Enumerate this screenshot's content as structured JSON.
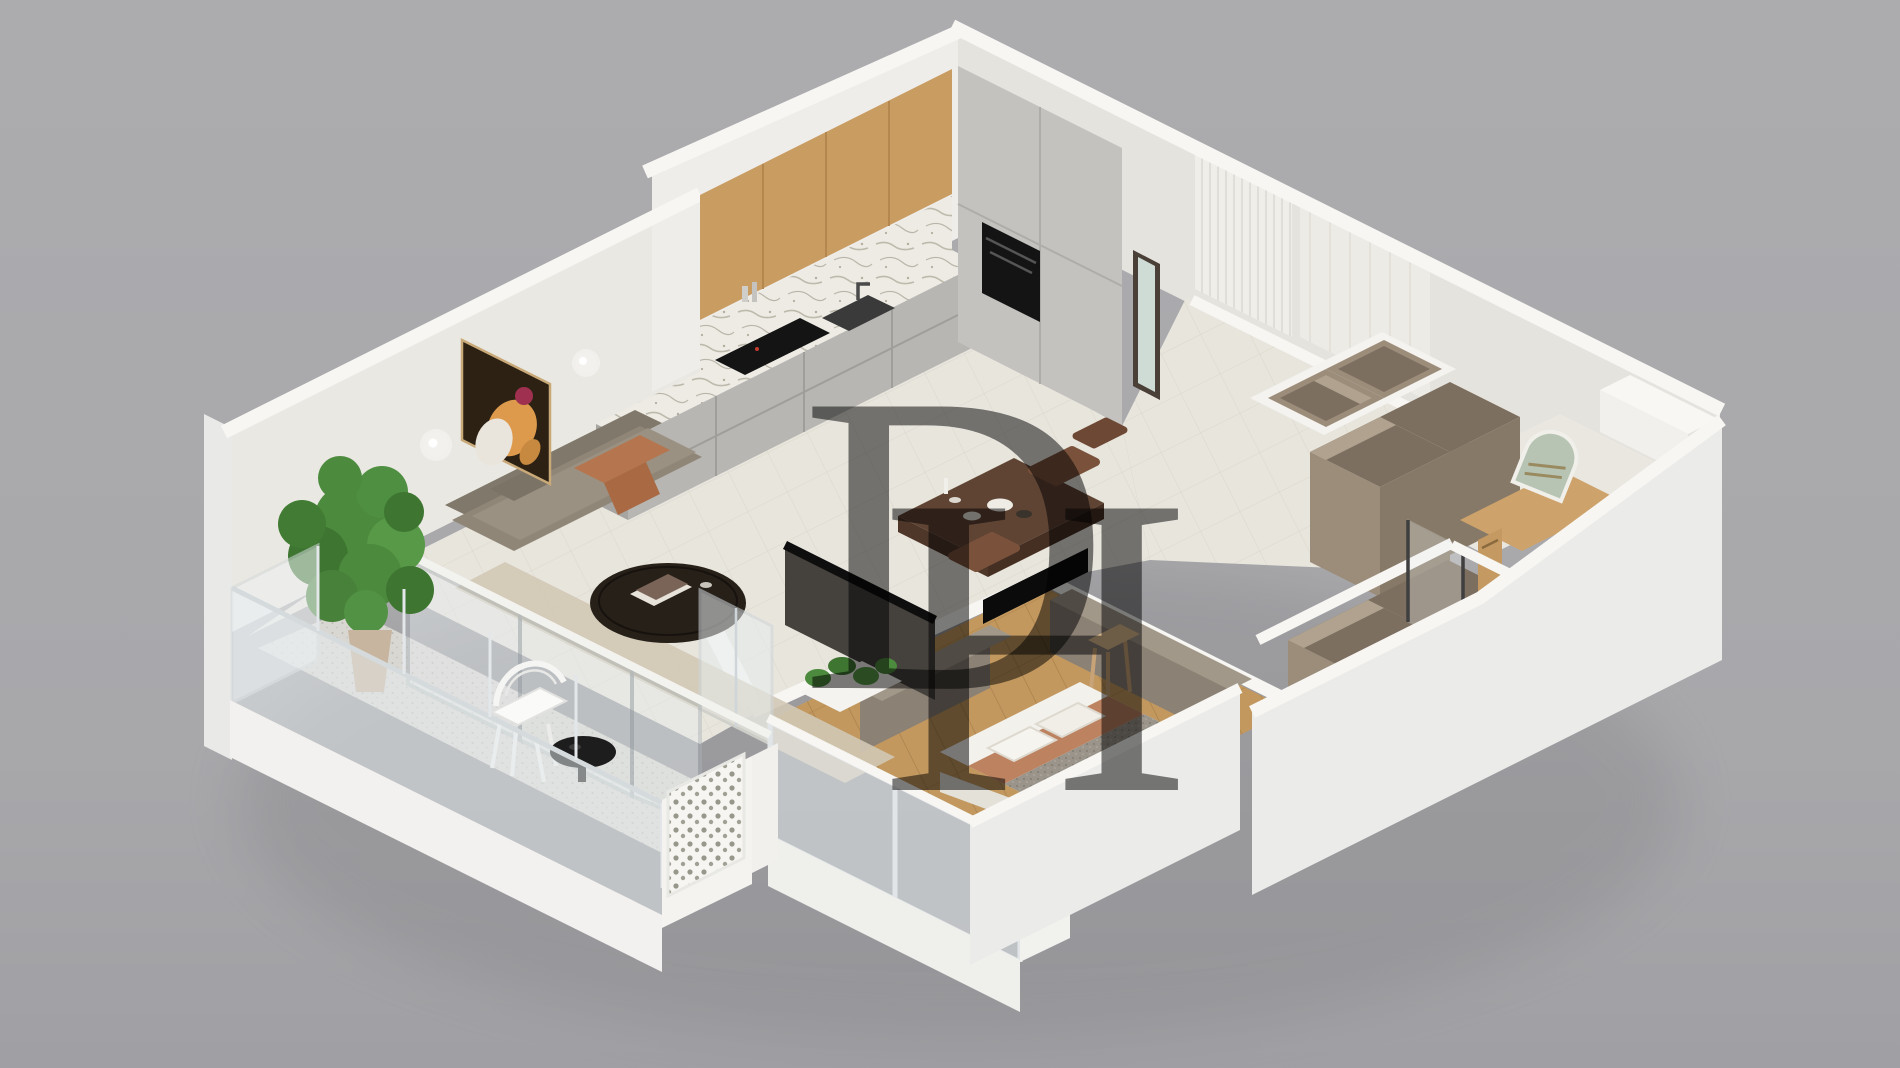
{
  "scene": {
    "description": "3D isometric cutaway render of a one-bedroom apartment floor plan on a neutral gray background",
    "view": "isometric dollhouse cutaway",
    "background": "#a9a9ac"
  },
  "watermark": {
    "d": "D",
    "h": "H",
    "color": "#f6f6f4",
    "opacity": 0.5
  },
  "palette": {
    "bg": "#a9a9ac",
    "bgBottom": "#a0a0a4",
    "shadow": "#6f6f73",
    "wallCap": "#fafaf8",
    "wallFaceSE": "#eae8e2",
    "wallFaceKitchen": "#eeede9",
    "wallFaceSW": "#e5e3dd",
    "wallOuter": "#e9e9e7",
    "wallOuterBig": "#ebebe9",
    "floorTile": "#e8e5dd",
    "tileLine": "#d7d3c7",
    "floorWood": "#c2985f",
    "woodLine": "#a07b45",
    "bathWood": "#cda26b",
    "balconyFloor": "#d9d7d2",
    "glass": "#e7edef",
    "glassFrame": "#aeb7bc",
    "marble": "#edebe3",
    "marbleVein": "#b2ad9f",
    "counterFace": "#b7b6b2",
    "counterEnd": "#a6a5a1",
    "cabinetTall": "#c3c2be",
    "woodCabinet": "#c99c62",
    "appliance": "#141414",
    "mirrorFrame": "#4a4038",
    "mirrorGlass": "#cfdcd6",
    "ribPanel": "#efeee9",
    "sofa": "#8f8678",
    "sofaBack": "#80786a",
    "sofaSeat": "#9a9183",
    "terracotta": "#b5754e",
    "rug": "#d2c8b5",
    "tableBlack": "#262019",
    "walnut": "#5f4434",
    "chairBrown": "#7a523b",
    "plantGreen": "#4c8a3d",
    "plantDark": "#3d7531",
    "pot": "#c7b5a0",
    "closetFace": "#9c8d7b",
    "closetInner": "#7d6f5f",
    "closetSide": "#877967",
    "closetLight": "#b0a28f",
    "bedWhite": "#f3f1ec",
    "bedGray": "#9a948a",
    "bedTerracotta": "#bd8260",
    "stool": "#dcbb8e",
    "tvBack": "#45423d",
    "black": "#0b0b0b",
    "deskTaupe": "#8b8175",
    "deskTop": "#a2988a",
    "artBg": "#2d2114",
    "artOrange": "#dd9a4d",
    "artRed": "#a03050",
    "artWhite": "#eae5dc",
    "archMirror": "#b7c4b4",
    "vanityWood": "#c49a62",
    "screenWhite": "#f6f5f1"
  },
  "rooms": [
    {
      "name": "kitchen",
      "items": [
        "wood upper cabinets",
        "marble backsplash and counter",
        "induction cooktop",
        "sink with faucet",
        "tall cabinets with built-in oven",
        "full-length mirror"
      ]
    },
    {
      "name": "living-room",
      "items": [
        "fabric sofa with terracotta throw",
        "round dark coffee table with books",
        "abstract wall art",
        "two wall sconces",
        "runner rug",
        "tall potted plant"
      ]
    },
    {
      "name": "dining-area",
      "items": [
        "walnut dining table",
        "wood chairs",
        "tableware",
        "black console",
        "tv panel"
      ]
    },
    {
      "name": "balcony",
      "items": [
        "glass balustrade",
        "white wire chair",
        "black side table",
        "perforated decorative screen",
        "sliding glass doors"
      ]
    },
    {
      "name": "bedroom",
      "items": [
        "double bed with terracotta and gray bedding",
        "wood plank floor",
        "taupe sideboard desk",
        "wooden stool",
        "glass window wall",
        "planter"
      ]
    },
    {
      "name": "hallway-closets",
      "items": [
        "open taupe wardrobe units",
        "wood thresholds"
      ]
    },
    {
      "name": "bathroom",
      "items": [
        "leaning arched mirror",
        "wall-hung wood vanity",
        "glass shower with dark poles"
      ]
    }
  ]
}
